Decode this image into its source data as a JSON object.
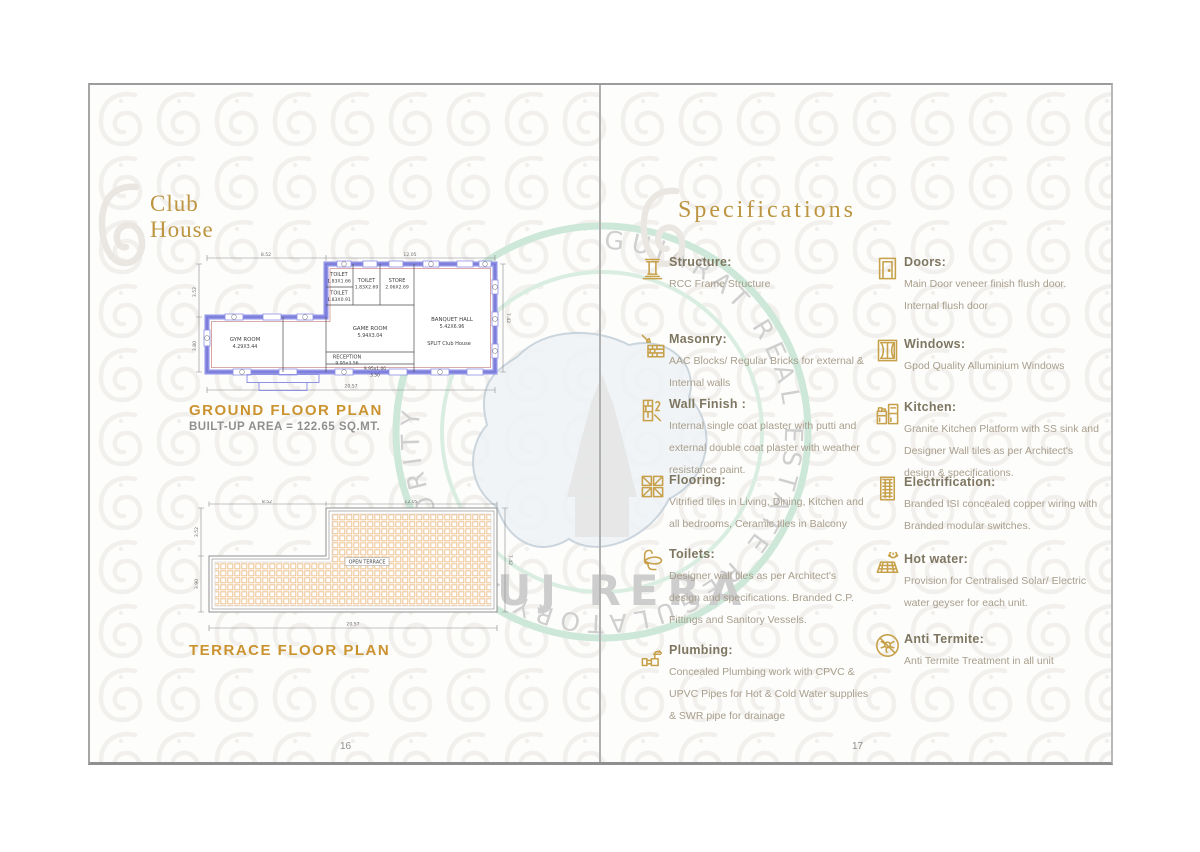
{
  "left_page": {
    "page_number": "16",
    "title_line1": "Club",
    "title_line2": "House",
    "ground_plan": {
      "title": "GROUND FLOOR PLAN",
      "area_note": "BUILT-UP AREA = 122.65 SQ.MT.",
      "rooms": {
        "gym": {
          "name": "GYM ROOM",
          "size": "4.29X3.44"
        },
        "reception": {
          "name": "RECEPTION",
          "size": "9.95x3.56"
        },
        "game": {
          "name": "GAME ROOM",
          "size": "5.94X3.04"
        },
        "toilet1": {
          "name": "TOILET",
          "size": "1.83X1.66"
        },
        "toilet2": {
          "name": "TOILET",
          "size": "1.83X0.91"
        },
        "toilet3": {
          "name": "TOILET",
          "size": "1.83X2.69"
        },
        "store": {
          "name": "STORE",
          "size": "2.06X2.69"
        },
        "banquet": {
          "name": "BANQUET HALL",
          "size": "5.42X6.96"
        },
        "split_note": "SPLIT Club House",
        "passage": "9.95x1.00",
        "passage2": "3.50"
      },
      "dims": {
        "top_left": "8.52",
        "top_right": "12.05",
        "left_upper": "3.52",
        "left_lower": "3.80",
        "inner": "3.79",
        "right": "7.42",
        "bottom": "20.57"
      }
    },
    "terrace_plan": {
      "title": "TERRACE FLOOR PLAN",
      "area_label": "OPEN TERRACE",
      "dims": {
        "top_left": "8.52",
        "top_right": "12.05",
        "left_upper": "3.52",
        "left_lower": "3.90",
        "right": "7.42",
        "bottom": "20.57"
      }
    }
  },
  "right_page": {
    "page_number": "17",
    "title": "Specifications",
    "items_left": [
      {
        "icon": "structure-icon",
        "heading": "Structure:",
        "body": "RCC Frame Structure"
      },
      {
        "icon": "masonry-icon",
        "heading": "Masonry:",
        "body": "AAC Blocks/ Regular Bricks for external & Internal walls"
      },
      {
        "icon": "wall-finish-icon",
        "heading": "Wall Finish :",
        "body": "Internal single coat plaster with putti and external double coat plaster with weather resistance paint."
      },
      {
        "icon": "flooring-icon",
        "heading": "Flooring:",
        "body": "Vitrified tiles in Living, Dining, Kitchen and all bedrooms, Ceramic tiles in Balcony"
      },
      {
        "icon": "toilets-icon",
        "heading": "Toilets:",
        "body": "Designer wall tiles as per Architect's design and specifications. Branded C.P. Fittings and Sanitory Vessels."
      },
      {
        "icon": "plumbing-icon",
        "heading": "Plumbing:",
        "body": "Concealed Plumbing work with CPVC & UPVC Pipes for Hot & Cold Water supplies & SWR pipe for drainage"
      }
    ],
    "items_right": [
      {
        "icon": "doors-icon",
        "heading": "Doors:",
        "body": "Main Door veneer finish flush door. Internal flush door"
      },
      {
        "icon": "windows-icon",
        "heading": "Windows:",
        "body": "Gpod Quality Alluminium Windows"
      },
      {
        "icon": "kitchen-icon",
        "heading": "Kitchen:",
        "body": "Granite Kitchen Platform with SS sink and Designer Wall tiles as per Architect's design & specifications."
      },
      {
        "icon": "electrification-icon",
        "heading": "Electrification:",
        "body": "Branded ISI concealed copper wiring with Branded modular switches."
      },
      {
        "icon": "hot-water-icon",
        "heading": "Hot water:",
        "body": "Provision for Centralised Solar/ Electric water geyser for each unit."
      },
      {
        "icon": "anti-termite-icon",
        "heading": "Anti Termite:",
        "body": "Anti Termite Treatment in all unit"
      }
    ]
  },
  "watermark": {
    "arc_text": "GUJARAT REAL ESTATE REGULATORY AUTHORITY",
    "center_text": "GUJ RERA"
  },
  "colors": {
    "gold": "#C19A3F",
    "plan_blue": "#9193E6",
    "plan_red": "#CF8F8F",
    "hatch_orange": "#EEC28F",
    "watermark_green": "#CDE8D8"
  }
}
